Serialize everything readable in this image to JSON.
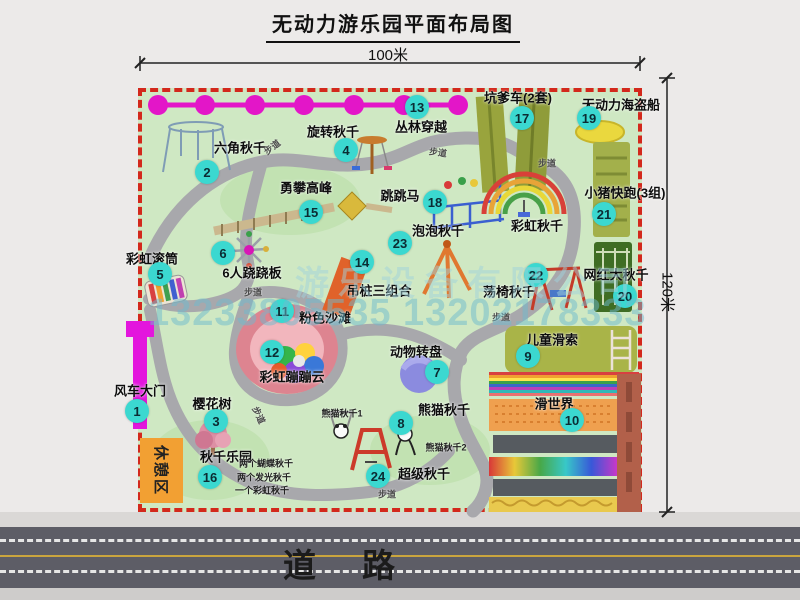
{
  "page": {
    "title": "无动力游乐园平面布局图"
  },
  "dimensions": {
    "top": "100米",
    "right": "120米"
  },
  "road": {
    "label": "道路"
  },
  "watermark": {
    "company": "游乐设备有限公司",
    "phone": "13233805535 13202178333"
  },
  "rest_area": {
    "label": "休憩区"
  },
  "colors": {
    "park_green": "#cfe8c3",
    "border_red": "#d3281c",
    "path_gray": "#a8a8ac",
    "badge_cyan": "#3bd8d0",
    "zipline_magenta": "#e316c8",
    "rest_orange": "#f2a033",
    "road_gray": "#5d5d66"
  },
  "icons": [
    "windmill-gate-icon",
    "zipline-icon",
    "hex-swing-icon",
    "spin-swing-icon",
    "rainbow-drum-icon",
    "seesaw-icon",
    "cherry-tree-icon",
    "animal-carousel-icon",
    "panda-swing-icon",
    "kids-zipline-icon",
    "slide-world-icon",
    "pink-beach-icon",
    "rainbow-cloud-icon",
    "hanging-pile-icon",
    "climbing-peak-icon",
    "pit-cart-icon",
    "jumping-horse-icon",
    "pirate-ship-icon",
    "big-swing-icon",
    "pig-run-icon",
    "chair-swing-icon",
    "bubble-swing-icon",
    "super-swing-icon",
    "rainbow-swing-icon"
  ],
  "park": {
    "items": [
      {
        "num": 1,
        "label": "风车大门",
        "bx": 137,
        "by": 411,
        "lx": 140,
        "ly": 390
      },
      {
        "num": 2,
        "label": "六角秋千",
        "bx": 207,
        "by": 172,
        "lx": 240,
        "ly": 147
      },
      {
        "num": 3,
        "label": "樱花树",
        "bx": 216,
        "by": 421,
        "lx": 212,
        "ly": 403
      },
      {
        "num": 4,
        "label": "旋转秋千",
        "bx": 346,
        "by": 150,
        "lx": 333,
        "ly": 131
      },
      {
        "num": 5,
        "label": "彩虹滚筒",
        "bx": 160,
        "by": 274,
        "lx": 152,
        "ly": 258
      },
      {
        "num": 6,
        "label": "6人跷跷板",
        "bx": 223,
        "by": 253,
        "lx": 252,
        "ly": 272
      },
      {
        "num": 7,
        "label": "动物转盘",
        "bx": 437,
        "by": 372,
        "lx": 416,
        "ly": 351
      },
      {
        "num": 8,
        "label": "熊猫秋千",
        "bx": 401,
        "by": 423,
        "lx": 444,
        "ly": 409,
        "notes": [
          {
            "text": "熊猫秋千1",
            "x": 342,
            "y": 413
          },
          {
            "text": "熊猫秋千2",
            "x": 446,
            "y": 447
          }
        ]
      },
      {
        "num": 9,
        "label": "儿童滑索",
        "bx": 528,
        "by": 356,
        "lx": 552,
        "ly": 339
      },
      {
        "num": 10,
        "label": "滑世界",
        "bx": 572,
        "by": 420,
        "lx": 554,
        "ly": 403
      },
      {
        "num": 11,
        "label": "粉色沙滩",
        "bx": 282,
        "by": 311,
        "lx": 325,
        "ly": 317
      },
      {
        "num": 12,
        "label": "彩虹蹦蹦云",
        "bx": 272,
        "by": 352,
        "lx": 292,
        "ly": 376
      },
      {
        "num": 13,
        "label": "丛林穿越",
        "bx": 417,
        "by": 107,
        "lx": 421,
        "ly": 126
      },
      {
        "num": 14,
        "label": "吊桩三组合",
        "bx": 362,
        "by": 262,
        "lx": 379,
        "ly": 290
      },
      {
        "num": 15,
        "label": "勇攀高峰",
        "bx": 311,
        "by": 212,
        "lx": 306,
        "ly": 187
      },
      {
        "num": 16,
        "label": "秋千乐园",
        "bx": 210,
        "by": 477,
        "lx": 226,
        "ly": 456,
        "notes": [
          {
            "text": "两个蝴蝶秋千",
            "x": 266,
            "y": 463
          },
          {
            "text": "两个发光秋千",
            "x": 264,
            "y": 477
          },
          {
            "text": "一个彩虹秋千",
            "x": 262,
            "y": 490
          }
        ]
      },
      {
        "num": 17,
        "label": "坑爹车(2套)",
        "bx": 522,
        "by": 118,
        "lx": 518,
        "ly": 97
      },
      {
        "num": 18,
        "label": "跳跳马",
        "bx": 435,
        "by": 202,
        "lx": 400,
        "ly": 195
      },
      {
        "num": 19,
        "label": "无动力海盗船",
        "bx": 589,
        "by": 118,
        "lx": 621,
        "ly": 104
      },
      {
        "num": 20,
        "label": "网红大秋千",
        "bx": 625,
        "by": 296,
        "lx": 616,
        "ly": 274
      },
      {
        "num": 21,
        "label": "小猪快跑(3组)",
        "bx": 604,
        "by": 214,
        "lx": 625,
        "ly": 192
      },
      {
        "num": 22,
        "label": "荡椅秋千",
        "bx": 536,
        "by": 275,
        "lx": 509,
        "ly": 291
      },
      {
        "num": 23,
        "label": "泡泡秋千",
        "bx": 400,
        "by": 243,
        "lx": 438,
        "ly": 230
      },
      {
        "num": 24,
        "label": "超级秋千",
        "bx": 378,
        "by": 476,
        "lx": 424,
        "ly": 473
      },
      {
        "num": null,
        "label": "彩虹秋千",
        "lx": 537,
        "ly": 225
      }
    ],
    "path_labels": [
      {
        "text": "步道",
        "x": 272,
        "y": 147,
        "rot": -38
      },
      {
        "text": "步道",
        "x": 438,
        "y": 152,
        "rot": 8
      },
      {
        "text": "步道",
        "x": 547,
        "y": 163,
        "rot": 0
      },
      {
        "text": "步道",
        "x": 253,
        "y": 292,
        "rot": 0
      },
      {
        "text": "步道",
        "x": 501,
        "y": 317,
        "rot": 0
      },
      {
        "text": "步道",
        "x": 259,
        "y": 415,
        "rot": 65
      },
      {
        "text": "步道",
        "x": 387,
        "y": 494,
        "rot": 0
      }
    ]
  }
}
